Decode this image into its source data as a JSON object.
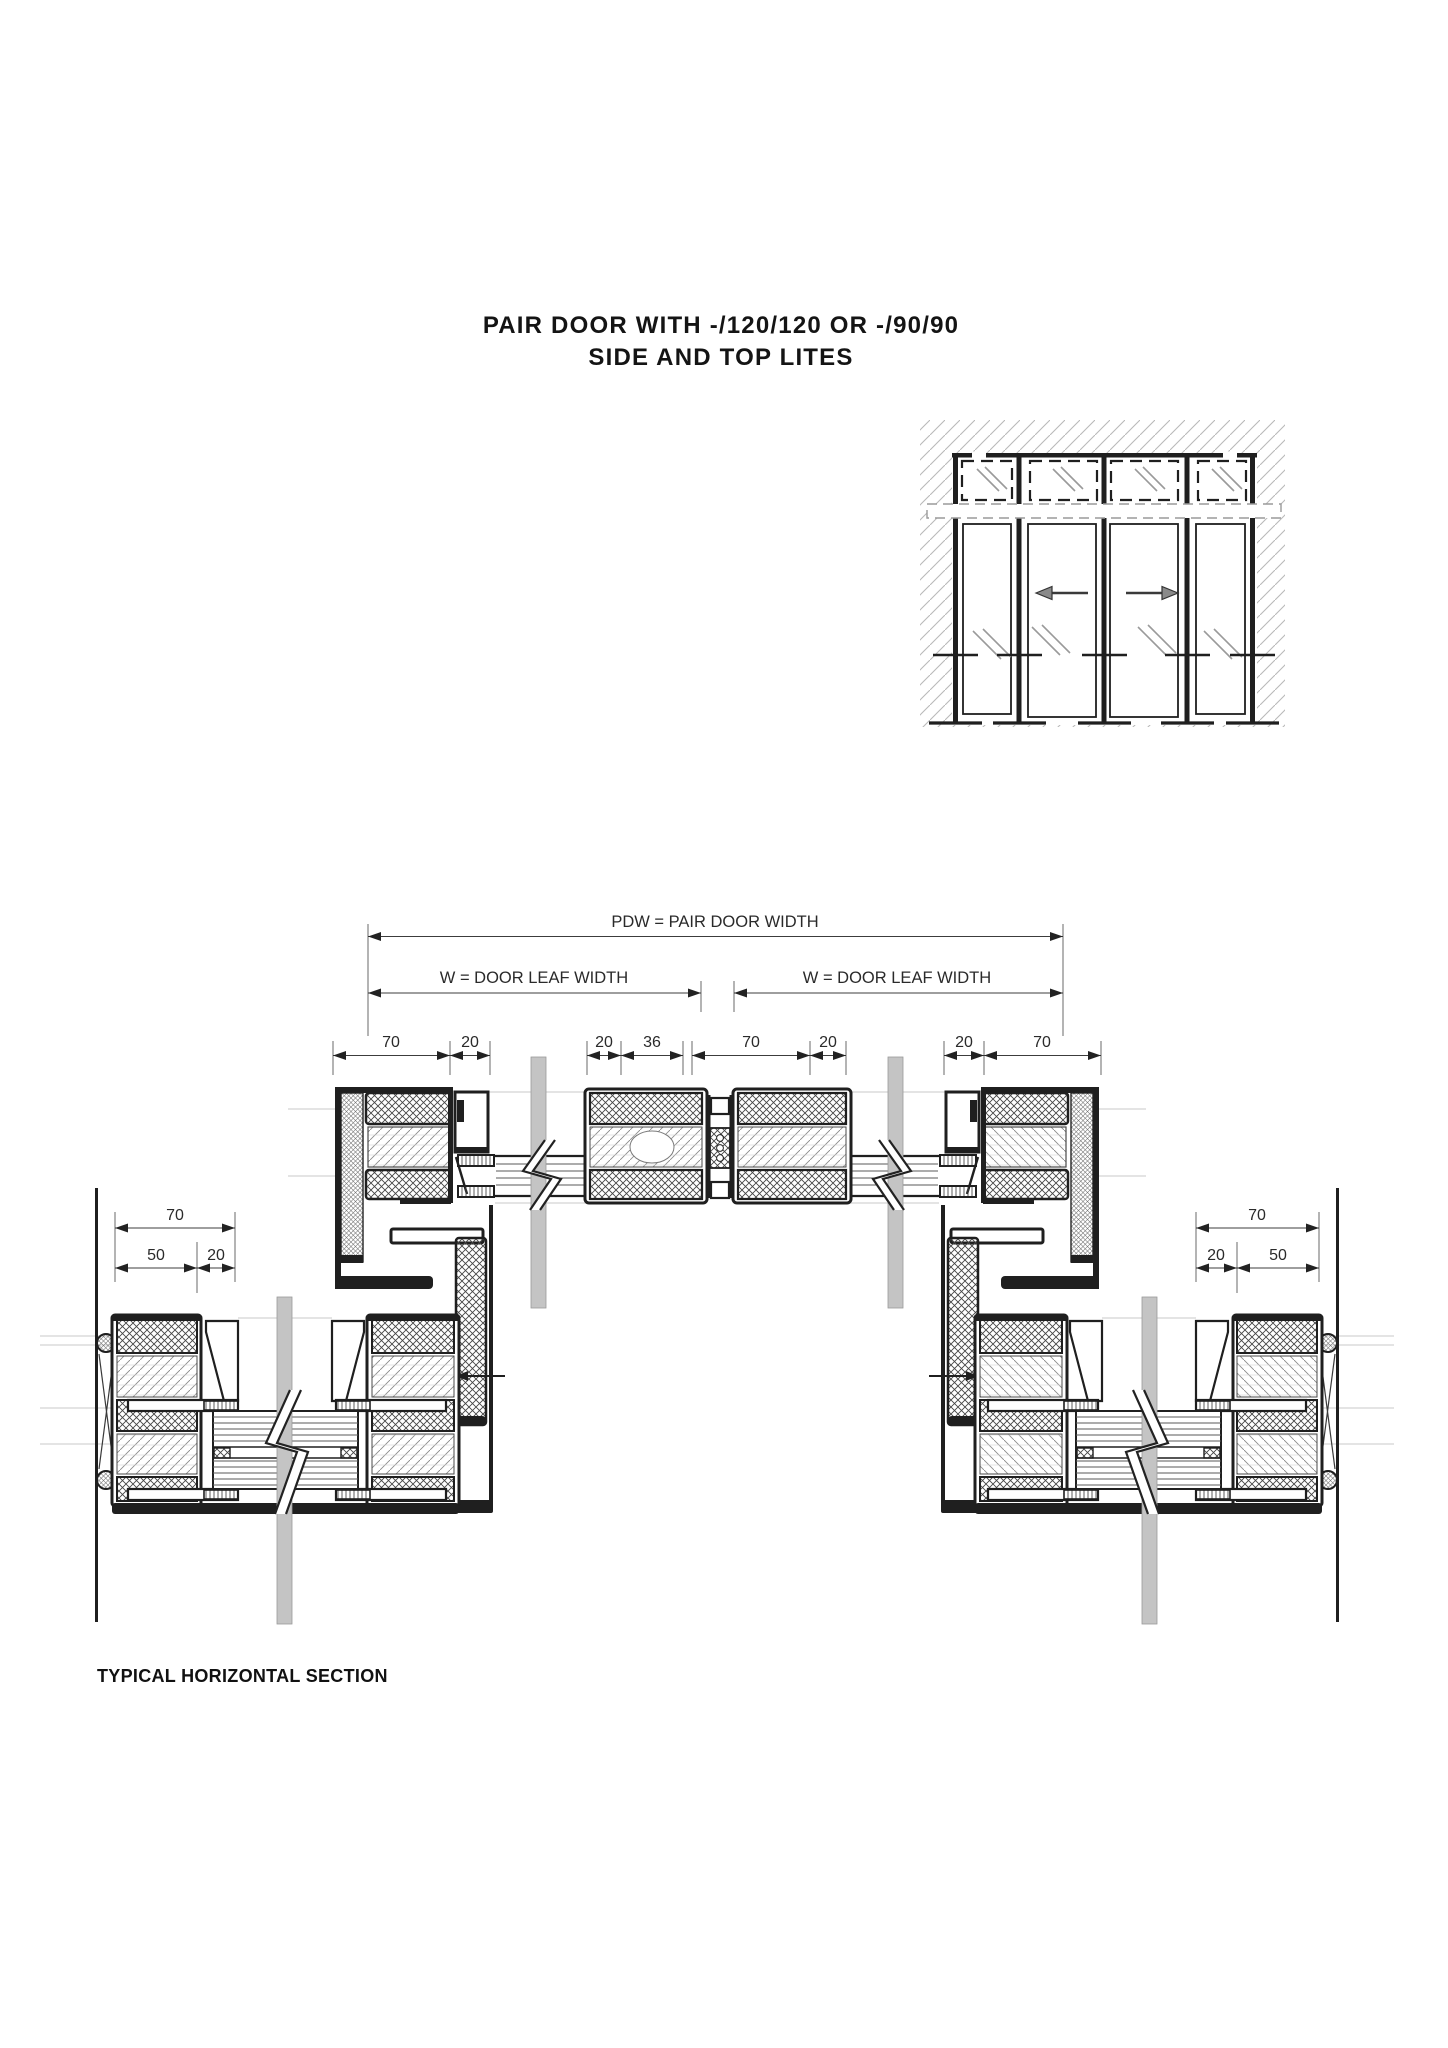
{
  "title": {
    "line1": "PAIR DOOR WITH -/120/120 OR -/90/90",
    "line2": "SIDE AND TOP LITES"
  },
  "dims": {
    "pdw_label": "PDW = PAIR DOOR WIDTH",
    "w_left_label": "W = DOOR LEAF WIDTH",
    "w_right_label": "W = DOOR LEAF WIDTH",
    "top_chain": [
      "70",
      "20",
      "20",
      "36",
      "70",
      "20",
      "20",
      "70"
    ],
    "left_total": "70",
    "left_inner": [
      "50",
      "20"
    ],
    "right_total": "70",
    "right_inner": [
      "20",
      "50"
    ]
  },
  "caption": "TYPICAL HORIZONTAL SECTION",
  "colors": {
    "line": "#1f1f1f",
    "dimension": "#3c3c3c",
    "break_bar": "#c4c4c4",
    "wall_hatch": "#b9b9b9",
    "faint_line": "#c9c9c9",
    "background": "#ffffff"
  }
}
